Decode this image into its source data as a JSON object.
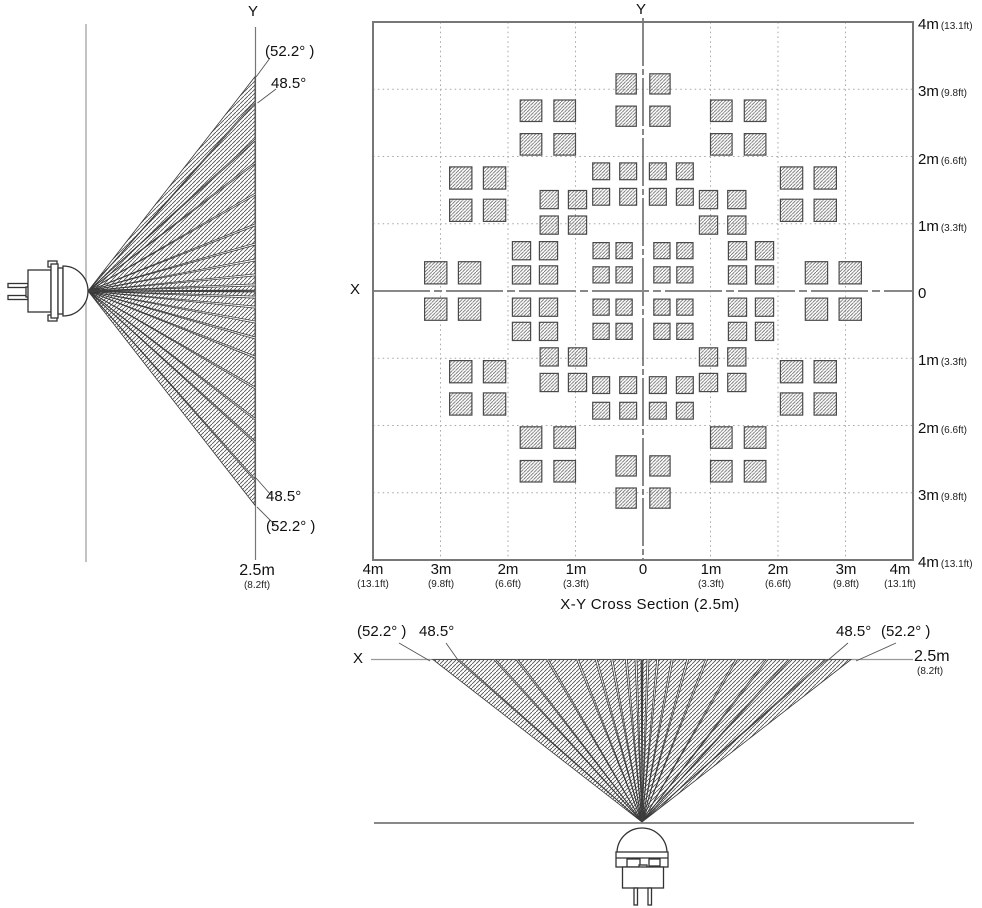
{
  "side_view": {
    "axis_top_label": "Y",
    "angle_outer_top": "(52.2° )",
    "angle_inner_top": "48.5°",
    "angle_inner_bottom": "48.5°",
    "angle_outer_bottom": "(52.2° )",
    "distance_label": "2.5m",
    "distance_sub": "(8.2ft)"
  },
  "cross_section": {
    "title": "X-Y Cross Section (2.5m)",
    "y_axis_label": "Y",
    "x_axis_label": "X",
    "right_ticks": [
      {
        "m": "4m",
        "ft": "(13.1ft)"
      },
      {
        "m": "3m",
        "ft": "(9.8ft)"
      },
      {
        "m": "2m",
        "ft": "(6.6ft)"
      },
      {
        "m": "1m",
        "ft": "(3.3ft)"
      },
      {
        "m": "0",
        "ft": ""
      },
      {
        "m": "1m",
        "ft": "(3.3ft)"
      },
      {
        "m": "2m",
        "ft": "(6.6ft)"
      },
      {
        "m": "3m",
        "ft": "(9.8ft)"
      },
      {
        "m": "4m",
        "ft": "(13.1ft)"
      }
    ],
    "bottom_ticks": [
      {
        "m": "4m",
        "ft": "(13.1ft)"
      },
      {
        "m": "3m",
        "ft": "(9.8ft)"
      },
      {
        "m": "2m",
        "ft": "(6.6ft)"
      },
      {
        "m": "1m",
        "ft": "(3.3ft)"
      },
      {
        "m": "0",
        "ft": ""
      },
      {
        "m": "1m",
        "ft": "(3.3ft)"
      },
      {
        "m": "2m",
        "ft": "(6.6ft)"
      },
      {
        "m": "3m",
        "ft": "(9.8ft)"
      },
      {
        "m": "4m",
        "ft": "(13.1ft)"
      }
    ]
  },
  "bottom_view": {
    "axis_label": "X",
    "angle_outer_left": "(52.2° )",
    "angle_inner_left": "48.5°",
    "angle_inner_right": "48.5°",
    "angle_outer_right": "(52.2° )",
    "distance_label": "2.5m",
    "distance_sub": "(8.2ft)"
  },
  "chart_data": {
    "type": "scatter",
    "title": "X-Y Cross Section (2.5m)",
    "units": "m",
    "x_range": [
      -4,
      4
    ],
    "y_range": [
      -4,
      4
    ],
    "detection_distance_m": 2.5,
    "detection_distance_ft": 8.2,
    "angles_deg": {
      "nominal_half_angle": 48.5,
      "max_half_angle": 52.2
    },
    "zone_clusters": [
      {
        "cx": 0.0,
        "cy": 2.84,
        "dx": 0.25,
        "dy": 0.24,
        "size": 0.3,
        "mirror": "y"
      },
      {
        "cx": 2.82,
        "cy": 0.0,
        "dx": 0.25,
        "dy": 0.27,
        "size": 0.33,
        "mirror": "x"
      },
      {
        "cx": 1.41,
        "cy": 2.43,
        "dx": 0.25,
        "dy": 0.25,
        "size": 0.32,
        "mirror": "xy"
      },
      {
        "cx": 2.45,
        "cy": 1.44,
        "dx": 0.25,
        "dy": 0.24,
        "size": 0.33,
        "mirror": "xy"
      },
      {
        "cx": 0.42,
        "cy": 1.59,
        "dx": 0.2,
        "dy": 0.19,
        "size": 0.25,
        "mirror": "xy"
      },
      {
        "cx": 1.18,
        "cy": 1.17,
        "dx": 0.21,
        "dy": 0.19,
        "size": 0.27,
        "mirror": "xy"
      },
      {
        "cx": 0.45,
        "cy": 0.42,
        "dx": 0.17,
        "dy": 0.18,
        "size": 0.24,
        "mirror": "xy"
      },
      {
        "cx": 1.6,
        "cy": 0.42,
        "dx": 0.2,
        "dy": 0.18,
        "size": 0.27,
        "mirror": "xy"
      }
    ],
    "fan_beams_deg": [
      [
        0,
        2.1
      ],
      [
        2.1,
        5.5
      ],
      [
        5.5,
        10.5
      ],
      [
        10.5,
        15.7
      ],
      [
        15.7,
        21.6
      ],
      [
        21.6,
        30.1
      ],
      [
        30.1,
        37.5
      ],
      [
        37.5,
        42.1
      ],
      [
        42.1,
        48.5
      ],
      [
        48.5,
        52.2
      ]
    ]
  }
}
